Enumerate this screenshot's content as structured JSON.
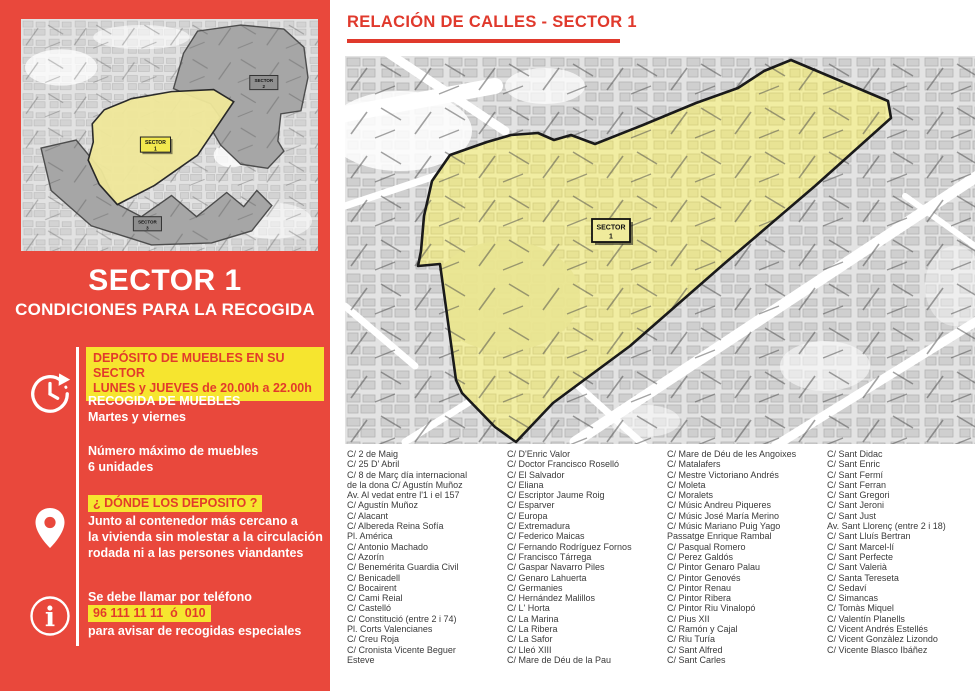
{
  "colors": {
    "sidebar_red": "#E9483C",
    "title_red": "#E0392C",
    "highlight_yellow": "#F6E52F",
    "sector_yellow": "#F1EDA2",
    "map_gray": "#E3E3E3",
    "other_sector_gray": "#A6A6A6"
  },
  "sidebar": {
    "minimap": {
      "sector1_label": [
        "SECTOR",
        "1"
      ],
      "sector2_label": [
        "SECTOR",
        "2"
      ],
      "sector3_label": [
        "SECTOR",
        "3"
      ]
    },
    "title": "SECTOR 1",
    "subtitle": "CONDICIONES PARA LA RECOGIDA",
    "schedule": {
      "highlight_line1": "DEPÓSITO DE MUEBLES EN SU SECTOR",
      "highlight_line2": "LUNES y JUEVES de 20.00h a 22.00h",
      "heading": "RECOGIDA DE MUEBLES",
      "days": "Martes y viernes",
      "max_label": "Número máximo de muebles",
      "max_value": "6 unidades"
    },
    "where": {
      "heading": "¿ DÓNDE LOS DEPOSITO ?",
      "line1": "Junto al contenedor más cercano a",
      "line2": "la vivienda sin molestar a la circulación",
      "line3": "rodada ni a las persones viandantes"
    },
    "phone": {
      "line1": "Se debe llamar por teléfono",
      "numbers": "96 111 11 11  ó  010",
      "line3": "para avisar de recogidas especiales"
    }
  },
  "main": {
    "title": "RELACIÓN DE CALLES - SECTOR 1",
    "map_label": [
      "SECTOR",
      "1"
    ],
    "street_columns": [
      [
        "C/ 2 de Maig",
        "C/ 25 D' Abril",
        "C/ 8 de Març día internacional",
        "de la dona C/ Agustín Muñoz",
        "Av. Al vedat entre l'1 i el 157",
        "C/ Agustín Muñoz",
        "C/ Alacant",
        "C/ Albereda Reina Sofía",
        "Pl. América",
        "C/ Antonio Machado",
        "C/ Azorín",
        "C/ Benemérita Guardia Civil",
        "C/ Benicadell",
        "C/ Bocairent",
        "C/ Cami Reial",
        "C/ Castelló",
        "C/ Constitució (entre 2 i 74)",
        "Pl. Corts Valencianes",
        "C/ Creu Roja",
        "C/ Cronista Vicente Beguer",
        "Esteve"
      ],
      [
        "C/ D'Enric Valor",
        "C/ Doctor Francisco Roselló",
        "C/ El Salvador",
        "C/ Eliana",
        "C/ Escriptor Jaume Roig",
        "C/ Esparver",
        "C/ Europa",
        "C/ Extremadura",
        "C/ Federico Maicas",
        "C/ Fernando Rodríguez Fornos",
        "C/ Francisco Tárrega",
        "C/ Gaspar Navarro Piles",
        "C/ Genaro Lahuerta",
        "C/ Germanies",
        "C/ Hernández Malillos",
        "C/ L' Horta",
        "C/ La Marina",
        "C/ La Ribera",
        "C/ La Safor",
        "C/ Lleó XIII",
        "C/ Mare de Déu de la Pau"
      ],
      [
        "C/ Mare de Déu de les Angoixes",
        "C/ Matalafers",
        "C/ Mestre Victoriano Andrés",
        "C/ Moleta",
        "C/ Moralets",
        "C/ Músic Andreu Piqueres",
        "C/ Músic José María Merino",
        "C/ Músic Mariano Puig Yago",
        "Passatge Enrique Rambal",
        "C/ Pasqual Romero",
        "C/ Perez Galdós",
        "C/ Pintor Genaro Palau",
        "C/ Pintor Genovés",
        "C/ Pintor Renau",
        "C/ Pintor Ribera",
        "C/ Pintor Riu Vinalopó",
        "C/ Pius XII",
        "C/ Ramón y Cajal",
        "C/ Riu Turía",
        "C/ Sant Alfred",
        "C/ Sant Carles"
      ],
      [
        "C/ Sant Didac",
        "C/ Sant Enric",
        "C/ Sant Fermí",
        "C/ Sant Ferran",
        "C/ Sant Gregori",
        "C/ Sant Jeroni",
        "C/ Sant Just",
        "Av. Sant Llorenç (entre 2 i 18)",
        "C/ Sant Lluís Bertran",
        "C/ Sant Marcel-lí",
        "C/ Sant Perfecte",
        "C/ Sant Valerià",
        "C/ Santa Tereseta",
        "C/ Sedaví",
        "C/ Simancas",
        "C/ Tomàs Miquel",
        "C/ Valentín Planells",
        "C/ Vicent Andrés Estellés",
        "C/ Vicent Gonzàlez Lizondo",
        "C/ Vicente Blasco Ibáñez"
      ]
    ]
  }
}
